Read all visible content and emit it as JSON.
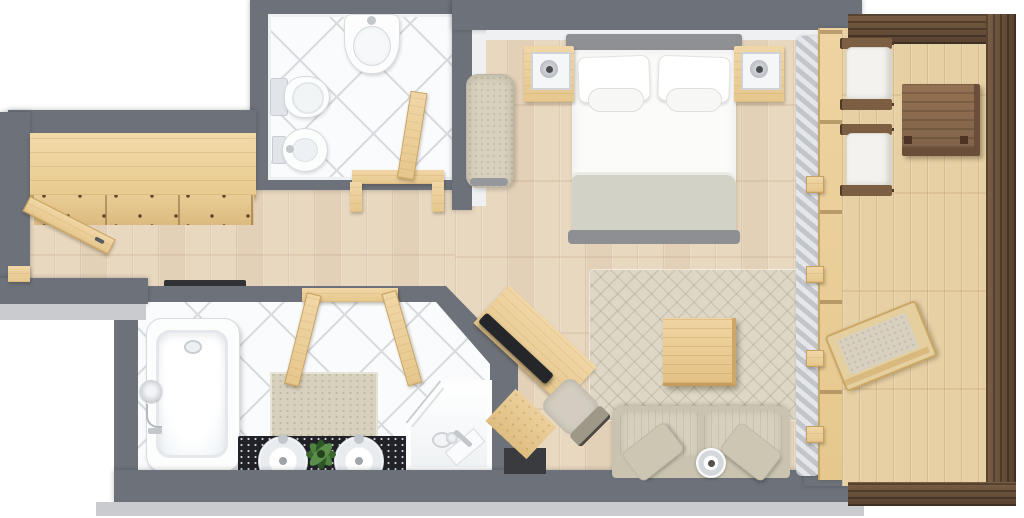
{
  "meta": {
    "title": "3D top-view floor plan of a suite with bedroom, living area, two bathrooms, entry hall and balcony",
    "canvas_width": 1024,
    "canvas_height": 518
  },
  "colors": {
    "wall": "#6d727a",
    "wallFace": "#c9cbce",
    "wallInner": "#eef0f2",
    "floor": "#e9d8c0",
    "deck": "#e7d0a4",
    "pine": "#ecd2a0",
    "brown": "#5d4836",
    "tableTop": "#8c6c4e",
    "tile": "#fafbfc",
    "tileLine": "#d8dbdf",
    "rug": "#ded7c6",
    "fabric": "#d7d1be",
    "cushion": "#d6d0be",
    "duvet": "#fbfbfa",
    "blanket": "#d3d2c6",
    "headboard": "#8f9094",
    "tv": "#24262a",
    "counter": "#202227",
    "plant": "#3c682f",
    "chrome": "#c3c7cc",
    "curtain": "#c2c5c9",
    "matDark": "#303236"
  },
  "rooms": [
    {
      "name": "entry-hall",
      "label": "Entry hall",
      "furniture": [
        "entry door (open)",
        "wardrobe with drawer fronts",
        "recessed floor mat"
      ]
    },
    {
      "name": "wc",
      "label": "Guest WC",
      "furniture": [
        "wall washbasin",
        "toilet",
        "bidet",
        "interior door (open)"
      ]
    },
    {
      "name": "bedroom",
      "label": "Bedroom",
      "furniture": [
        "double bed with two pillows and blanket",
        "left nightstand with lamp",
        "right nightstand with lamp",
        "upholstered bench"
      ]
    },
    {
      "name": "living-area",
      "label": "Living area",
      "furniture": [
        "area rug",
        "wooden coffee table",
        "sofa with two pillows and bowl",
        "corner TV desk",
        "desk chair",
        "curtain",
        "window wall to balcony"
      ]
    },
    {
      "name": "bathroom",
      "label": "Bathroom",
      "furniture": [
        "bathtub with shower mixer",
        "bath mat",
        "double vanity with plant",
        "corner shower",
        "double interior doors"
      ]
    },
    {
      "name": "balcony",
      "label": "Balcony",
      "furniture": [
        "armchair with cushion (upper)",
        "armchair with cushion (lower)",
        "wooden side table",
        "folded sun lounger"
      ]
    }
  ]
}
